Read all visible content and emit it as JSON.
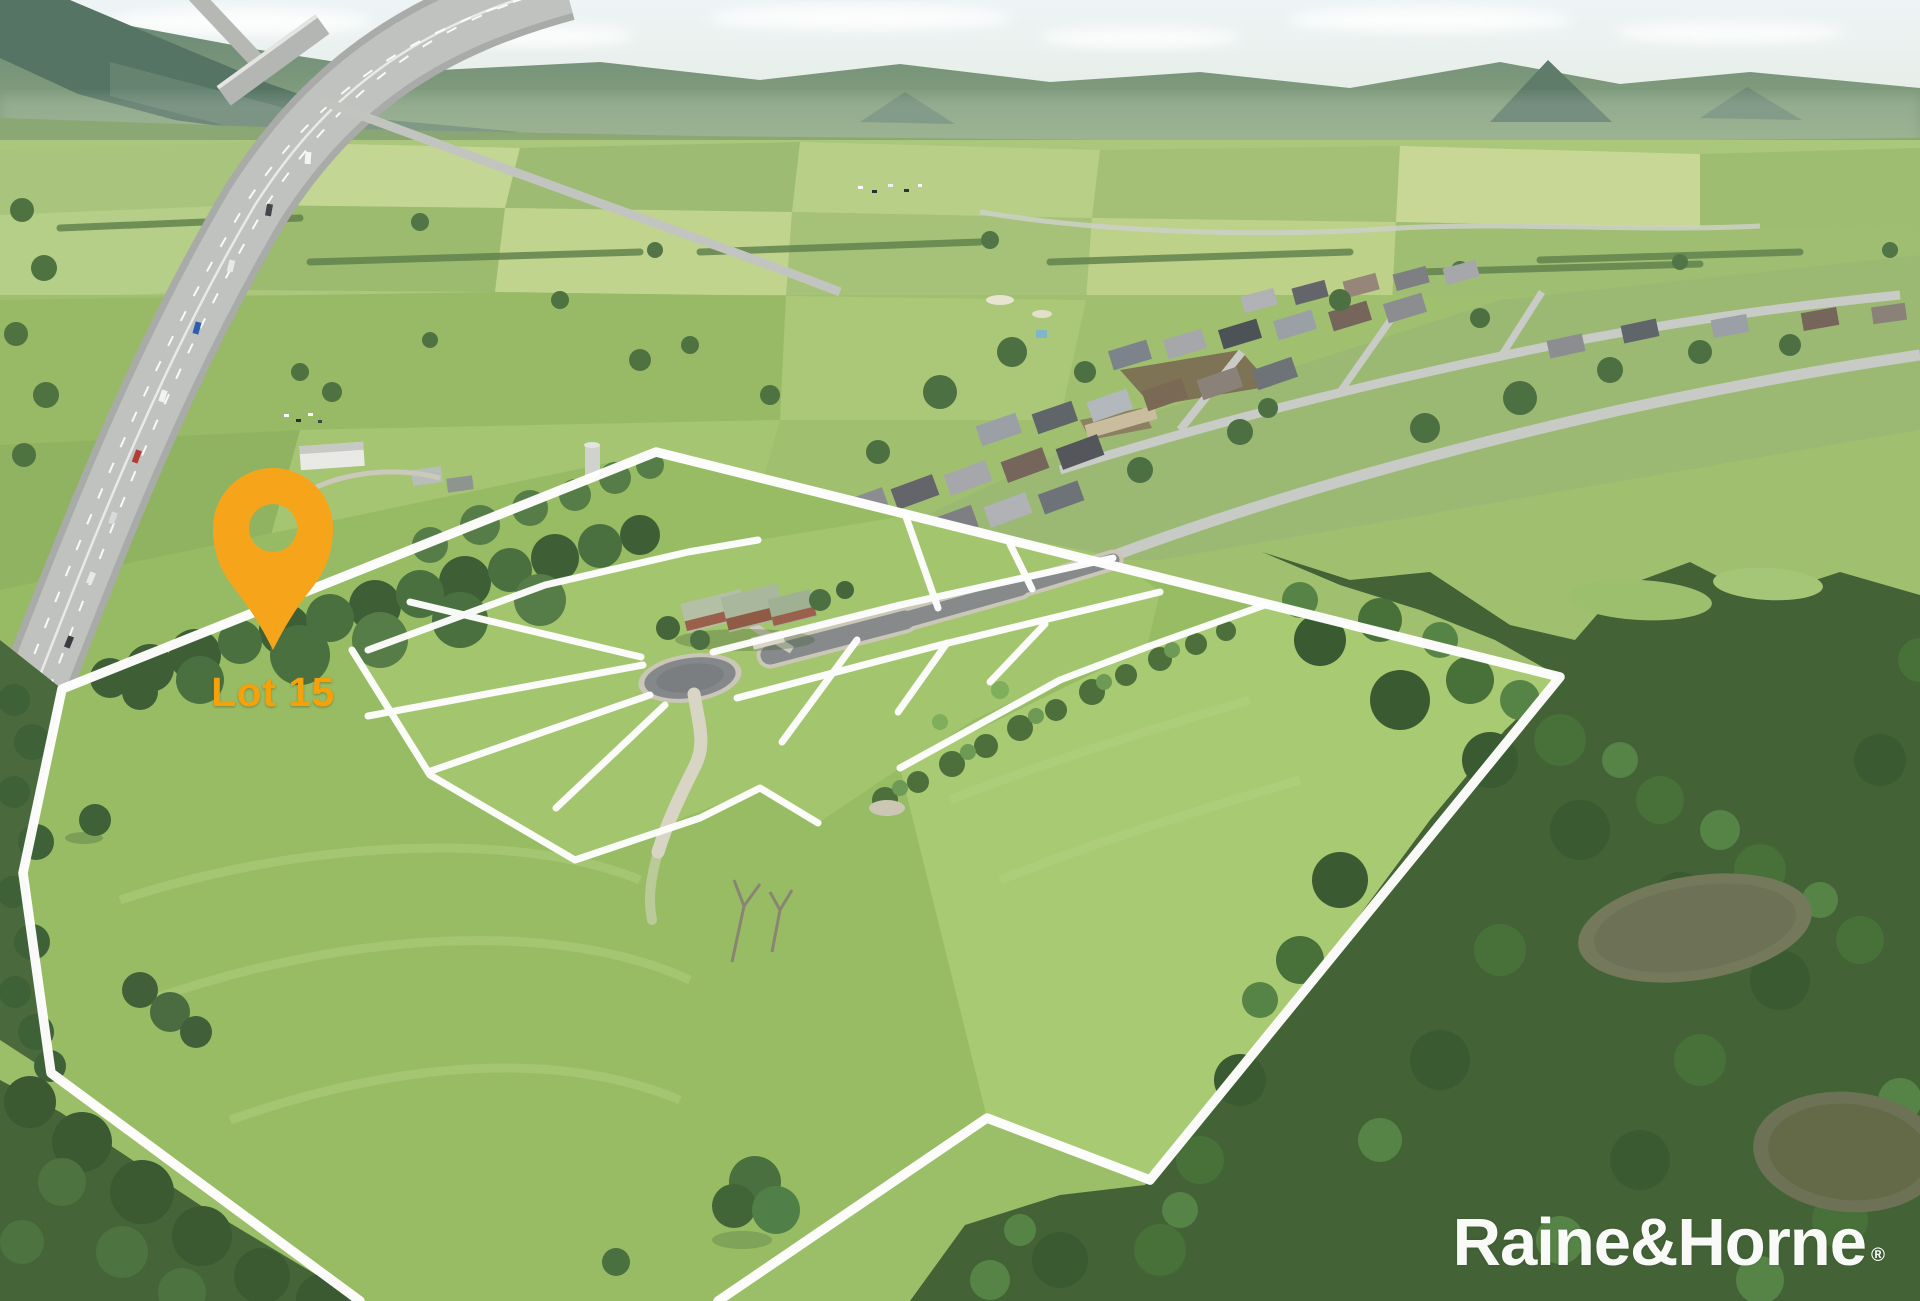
{
  "annotations": {
    "lot_pin_label": "Lot 15"
  },
  "branding": {
    "logo_text": "Raine&Horne",
    "registered_mark": "®"
  },
  "colors": {
    "pin": "#F6A51B",
    "lot_label_text": "#F5A10C",
    "boundary_lines": "#FFFFFF",
    "logo_text": "#FFFFFF",
    "sealed_road": "#878A8B",
    "grass": "#9ABF68",
    "forest": "#46683A"
  }
}
